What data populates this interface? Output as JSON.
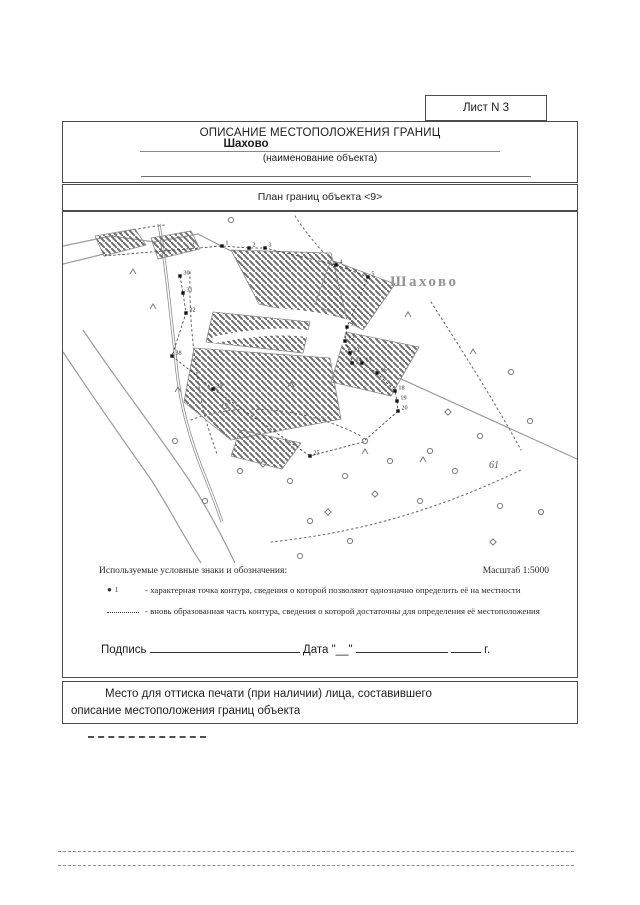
{
  "page": {
    "sheet_label": "Лист N 3",
    "title": "ОПИСАНИЕ МЕСТОПОЛОЖЕНИЯ ГРАНИЦ",
    "object_name": "Шахово",
    "object_name_caption": "(наименование объекта)",
    "plan_title": "План границ объекта <9>"
  },
  "legend": {
    "heading": "Используемые условные знаки и обозначения:",
    "scale": "Масштаб 1:5000",
    "items": [
      {
        "symbol": "point-marker",
        "marker_glyph": "●",
        "marker_label": "1",
        "text": "- характерная точка контура, сведения о которой позволяют однозначно определить её на местности"
      },
      {
        "symbol": "dotted-line",
        "text": "- вновь образованная часть контура, сведения о которой достаточны для определения её местоположения"
      }
    ]
  },
  "signature": {
    "label": "Подпись",
    "date_label": "Дата",
    "day_placeholder": "\"__\"",
    "year_suffix": "г."
  },
  "stamp_note": "Место для оттиска печати (при наличии) лица, составившего описание местоположения границ объекта",
  "map": {
    "place_label": {
      "text": "Шахово",
      "x": 327,
      "y": 74
    },
    "area_label": {
      "text": "61",
      "x": 426,
      "y": 256
    },
    "hatch_color": "#6e6e6e",
    "polygons": [
      [
        [
          32,
          24
        ],
        [
          72,
          17
        ],
        [
          83,
          33
        ],
        [
          41,
          44
        ]
      ],
      [
        [
          88,
          26
        ],
        [
          128,
          19
        ],
        [
          137,
          37
        ],
        [
          95,
          47
        ]
      ],
      [
        [
          168,
          38
        ],
        [
          268,
          41
        ],
        [
          285,
          112
        ],
        [
          196,
          92
        ]
      ],
      [
        [
          268,
          48
        ],
        [
          332,
          72
        ],
        [
          300,
          118
        ],
        [
          252,
          92
        ]
      ],
      [
        [
          150,
          100
        ],
        [
          247,
          110
        ],
        [
          240,
          141
        ],
        [
          143,
          130
        ]
      ],
      [
        [
          131,
          136
        ],
        [
          267,
          146
        ],
        [
          278,
          207
        ],
        [
          168,
          228
        ],
        [
          121,
          190
        ]
      ],
      [
        [
          283,
          120
        ],
        [
          356,
          135
        ],
        [
          328,
          184
        ],
        [
          268,
          170
        ]
      ],
      [
        [
          177,
          218
        ],
        [
          238,
          231
        ],
        [
          219,
          257
        ],
        [
          168,
          244
        ]
      ]
    ],
    "white_paths": [
      "M150,128 C200,118 240,116 283,130",
      "M172,96 C212,100 252,100 286,112"
    ],
    "roads": [
      "M0,34 L48,24 L92,30 L135,22 L168,39",
      "M0,52 L41,42",
      "M336,166 L514,247",
      "M20,118 C55,170 90,215 122,262 C140,288 158,322 172,351",
      "M0,140 C30,185 60,228 89,269 C106,296 124,330 138,351"
    ],
    "streams": [
      "M96,12 C104,60 107,100 112,140 C115,180 122,212 137,252 C145,272 153,292 159,310"
    ],
    "dotted": [
      "M48,24 C62,19 82,15 102,13",
      "M127,60 C126,100 130,140 137,180 C140,202 147,222 154,242",
      "M128,208 C172,190 240,194 298,224",
      "M208,330 C282,322 362,304 458,258",
      "M368,90 C400,140 432,190 458,238",
      "M232,4 C241,18 251,30 260,40"
    ],
    "chains": [
      [
        [
          41,
          44
        ],
        [
          159,
          34
        ],
        [
          186,
          36
        ],
        [
          202,
          36
        ],
        [
          273,
          53
        ],
        [
          305,
          65
        ],
        [
          284,
          115
        ]
      ],
      [
        [
          284,
          115
        ],
        [
          282,
          129
        ],
        [
          287,
          141
        ],
        [
          289,
          151
        ],
        [
          299,
          151
        ],
        [
          314,
          161
        ],
        [
          332,
          179
        ],
        [
          334,
          189
        ],
        [
          335,
          199
        ]
      ],
      [
        [
          117,
          64
        ],
        [
          120,
          81
        ],
        [
          123,
          101
        ],
        [
          109,
          144
        ],
        [
          150,
          177
        ]
      ],
      [
        [
          150,
          177
        ],
        [
          247,
          244
        ]
      ],
      [
        [
          335,
          199
        ],
        [
          300,
          230
        ],
        [
          247,
          244
        ]
      ]
    ],
    "points": [
      {
        "x": 159,
        "y": 34,
        "label": "1"
      },
      {
        "x": 186,
        "y": 36,
        "label": "2"
      },
      {
        "x": 202,
        "y": 36,
        "label": "3"
      },
      {
        "x": 273,
        "y": 53,
        "label": "4"
      },
      {
        "x": 305,
        "y": 65,
        "label": "5"
      },
      {
        "x": 284,
        "y": 115,
        "label": "9"
      },
      {
        "x": 282,
        "y": 129,
        "label": "12"
      },
      {
        "x": 287,
        "y": 141,
        "label": "13"
      },
      {
        "x": 289,
        "y": 151,
        "label": "14"
      },
      {
        "x": 299,
        "y": 151,
        "label": "15"
      },
      {
        "x": 314,
        "y": 161,
        "label": "16"
      },
      {
        "x": 332,
        "y": 179,
        "label": "18"
      },
      {
        "x": 334,
        "y": 189,
        "label": "19"
      },
      {
        "x": 335,
        "y": 199,
        "label": "20"
      },
      {
        "x": 247,
        "y": 244,
        "label": "25"
      },
      {
        "x": 117,
        "y": 64,
        "label": "30"
      },
      {
        "x": 120,
        "y": 81,
        "label": "31"
      },
      {
        "x": 123,
        "y": 101,
        "label": "32"
      },
      {
        "x": 109,
        "y": 144,
        "label": "38"
      },
      {
        "x": 150,
        "y": 177,
        "label": "39"
      }
    ],
    "symbols": {
      "circles": [
        [
          168,
          8
        ],
        [
          162,
          194
        ],
        [
          112,
          229
        ],
        [
          142,
          289
        ],
        [
          177,
          259
        ],
        [
          227,
          269
        ],
        [
          247,
          309
        ],
        [
          282,
          264
        ],
        [
          302,
          229
        ],
        [
          327,
          249
        ],
        [
          367,
          239
        ],
        [
          392,
          259
        ],
        [
          417,
          224
        ],
        [
          357,
          289
        ],
        [
          287,
          329
        ],
        [
          237,
          344
        ],
        [
          437,
          294
        ],
        [
          467,
          209
        ],
        [
          448,
          160
        ],
        [
          478,
          300
        ]
      ],
      "diamonds": [
        [
          200,
          252
        ],
        [
          312,
          282
        ],
        [
          385,
          200
        ],
        [
          430,
          330
        ],
        [
          265,
          300
        ]
      ],
      "trees": [
        [
          90,
          95
        ],
        [
          115,
          178
        ],
        [
          228,
          173
        ],
        [
          345,
          103
        ],
        [
          360,
          248
        ],
        [
          132,
          32
        ],
        [
          302,
          240
        ],
        [
          70,
          60
        ],
        [
          410,
          140
        ]
      ]
    }
  }
}
